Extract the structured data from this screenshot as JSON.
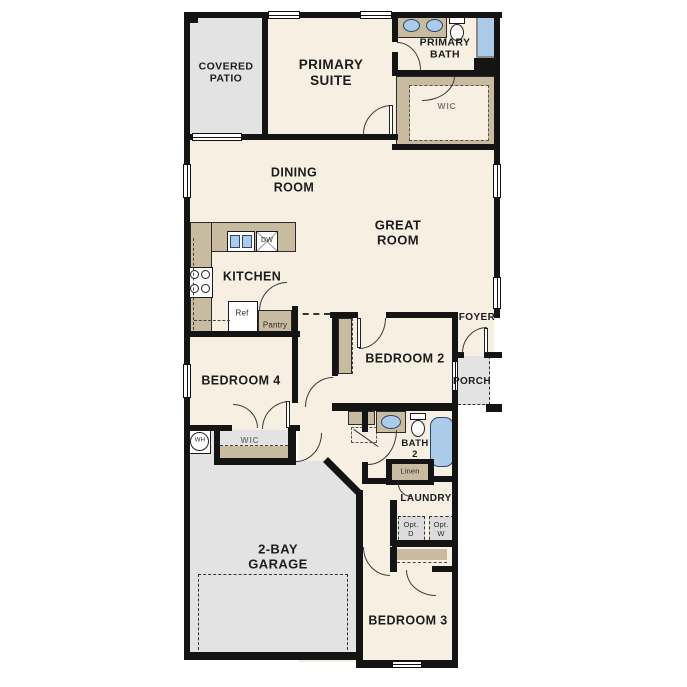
{
  "plan_title": "single-story floor plan",
  "colors": {
    "wall": "#141414",
    "floor": "#f6efe2",
    "outdoor_concrete": "#e3e3e3",
    "casework_tan": "#c9bba0",
    "fixture_blue": "#abcbe9"
  },
  "rooms": {
    "covered_patio": {
      "label": "COVERED\nPATIO"
    },
    "primary_suite": {
      "label": "PRIMARY\nSUITE"
    },
    "primary_bath": {
      "label": "PRIMARY\nBATH"
    },
    "primary_wic": {
      "label": "WIC"
    },
    "dining_room": {
      "label": "DINING\nROOM"
    },
    "great_room": {
      "label": "GREAT\nROOM"
    },
    "kitchen": {
      "label": "KITCHEN"
    },
    "bedroom_2": {
      "label": "BEDROOM 2"
    },
    "bedroom_4": {
      "label": "BEDROOM 4"
    },
    "bedroom_4_wic": {
      "label": "WIC"
    },
    "foyer": {
      "label": "FOYER"
    },
    "porch": {
      "label": "PORCH"
    },
    "bath_2": {
      "label": "BATH\n2"
    },
    "laundry": {
      "label": "LAUNDRY"
    },
    "garage": {
      "label": "2-BAY\nGARAGE"
    },
    "bedroom_3": {
      "label": "BEDROOM 3"
    }
  },
  "fixtures": {
    "refrigerator": "Ref",
    "pantry": "Pantry",
    "dishwasher": "DW",
    "water_heater": "WH",
    "linen": "Linen",
    "opt_dryer": "Opt.\nD",
    "opt_washer": "Opt.\nW"
  }
}
